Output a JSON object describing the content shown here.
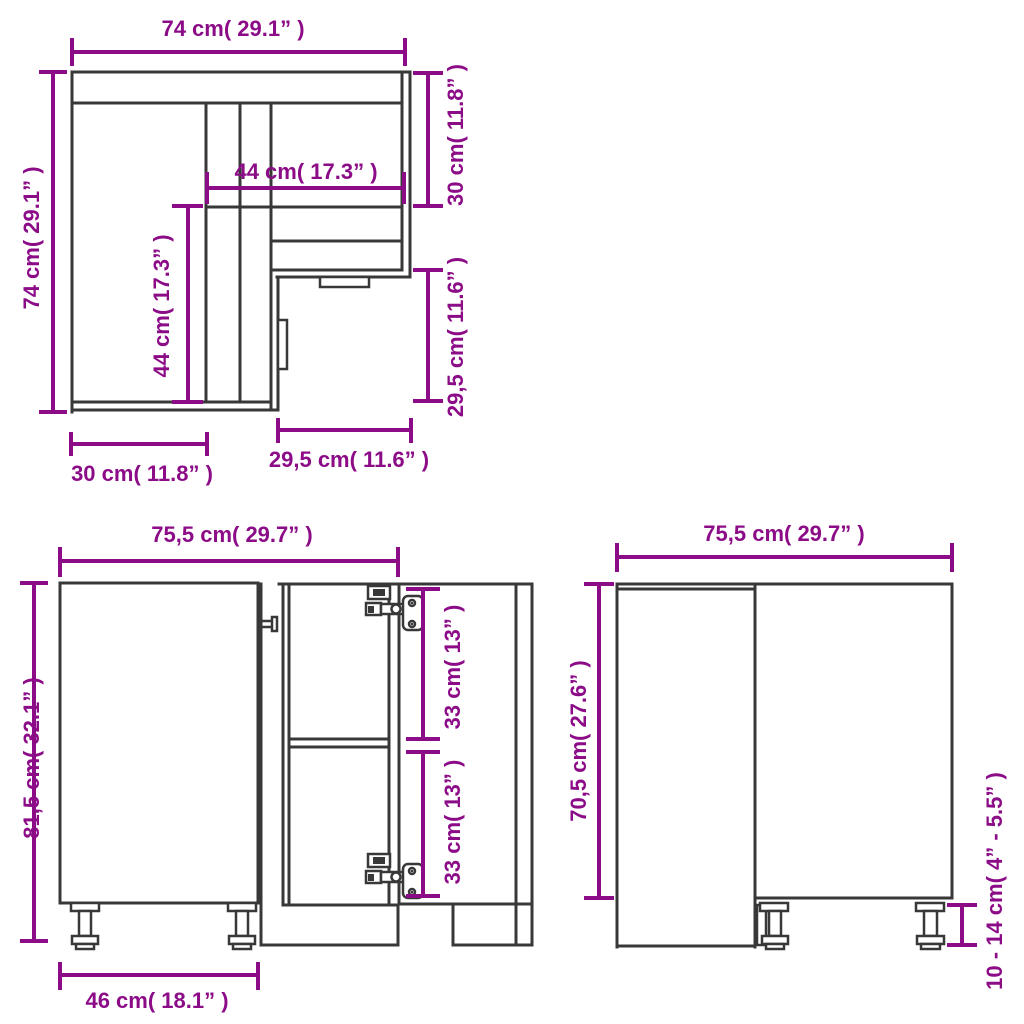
{
  "title": "Corner kitchen base cabinet dimension diagram",
  "colors": {
    "dimension": "#8C0C88",
    "outline": "#383838",
    "background": "#FFFFFF"
  },
  "views": {
    "top": {
      "name": "top view",
      "dims": {
        "overall_width": "74 cm( 29.1” )",
        "overall_depth": "74 cm( 29.1” )",
        "right_section_depth": "30 cm( 11.8” )",
        "inner_width": "44 cm( 17.3” )",
        "inner_depth": "44 cm( 17.3” )",
        "right_front_width": "29,5 cm( 11.6” )",
        "left_section_width": "30 cm( 11.8” )",
        "right_section_front": "29,5 cm( 11.6” )"
      }
    },
    "front": {
      "name": "front view",
      "dims": {
        "width": "75,5 cm( 29.7” )",
        "total_height": "81,5 cm( 32.1” )",
        "upper_opening_height": "33 cm( 13” )",
        "lower_opening_height": "33 cm( 13” )",
        "door_width": "46 cm( 18.1” )"
      }
    },
    "side": {
      "name": "side view",
      "dims": {
        "width": "75,5 cm( 29.7” )",
        "body_height": "70,5 cm( 27.6” )",
        "leg_height": "10 - 14 cm( 4” - 5.5” )"
      }
    }
  }
}
